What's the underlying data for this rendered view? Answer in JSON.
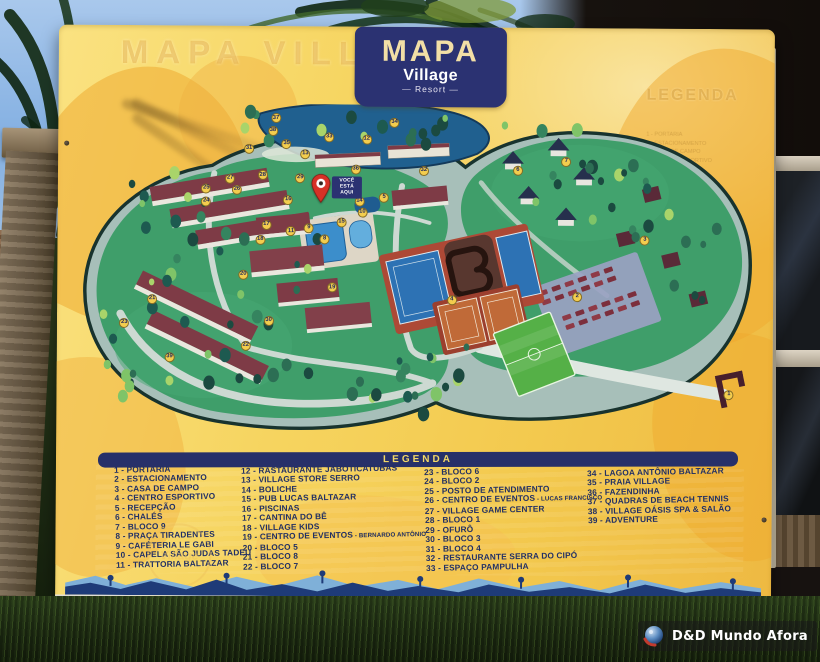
{
  "sign": {
    "title": "MAPA",
    "brand": "Village",
    "brand_sub": "— Resort —",
    "ghost_title": "MAPA VILLAGE",
    "ghost_legend_title": "LEGENDA",
    "you_are_here": "VOCÊ ESTÁ AQUI",
    "legend": {
      "title": "LEGENDA",
      "columns": [
        [
          {
            "n": 1,
            "label": "PORTARIA"
          },
          {
            "n": 2,
            "label": "ESTACIONAMENTO"
          },
          {
            "n": 3,
            "label": "CASA DE CAMPO"
          },
          {
            "n": 4,
            "label": "CENTRO ESPORTIVO"
          },
          {
            "n": 5,
            "label": "RECEPÇÃO"
          },
          {
            "n": 6,
            "label": "CHALÉS"
          },
          {
            "n": 7,
            "label": "BLOCO 9"
          },
          {
            "n": 8,
            "label": "PRAÇA TIRADENTES"
          },
          {
            "n": 9,
            "label": "CAFÉTERIA LE GABI"
          },
          {
            "n": 10,
            "label": "CAPELA SÃO JUDAS TADEU"
          },
          {
            "n": 11,
            "label": "TRATTORIA BALTAZAR"
          }
        ],
        [
          {
            "n": 12,
            "label": "RASTAURANTE JABOTICATUBAS"
          },
          {
            "n": 13,
            "label": "VILLAGE STORE SERRO"
          },
          {
            "n": 14,
            "label": "BOLICHE"
          },
          {
            "n": 15,
            "label": "PUB LUCAS BALTAZAR"
          },
          {
            "n": 16,
            "label": "PISCINAS"
          },
          {
            "n": 17,
            "label": "CANTINA DO BÊ"
          },
          {
            "n": 18,
            "label": "VILLAGE KIDS"
          },
          {
            "n": 19,
            "label": "CENTRO DE EVENTOS",
            "sublabel": "BERNARDO ANTÔNIO"
          },
          {
            "n": 20,
            "label": "BLOCO 5"
          },
          {
            "n": 21,
            "label": "BLOCO 8"
          },
          {
            "n": 22,
            "label": "BLOCO 7"
          }
        ],
        [
          {
            "n": 23,
            "label": "BLOCO 6"
          },
          {
            "n": 24,
            "label": "BLOCO 2"
          },
          {
            "n": 25,
            "label": "POSTO DE ATENDIMENTO"
          },
          {
            "n": 26,
            "label": "CENTRO DE EVENTOS",
            "sublabel": "LUCAS FRANCISCO"
          },
          {
            "n": 27,
            "label": "VILLAGE GAME CENTER"
          },
          {
            "n": 28,
            "label": "BLOCO 1"
          },
          {
            "n": 29,
            "label": "OFURÔ"
          },
          {
            "n": 30,
            "label": "BLOCO 3"
          },
          {
            "n": 31,
            "label": "BLOCO 4"
          },
          {
            "n": 32,
            "label": "RESTAURANTE SERRA DO CIPÓ"
          },
          {
            "n": 33,
            "label": "ESPAÇO PAMPULHA"
          }
        ],
        [
          {
            "n": 34,
            "label": "LAGOA ANTÔNIO BALTAZAR"
          },
          {
            "n": 35,
            "label": "PRAIA VILLAGE"
          },
          {
            "n": 36,
            "label": "FAZENDINHA"
          },
          {
            "n": 37,
            "label": "QUADRAS DE BEACH TENNIS"
          },
          {
            "n": 38,
            "label": "VILLAGE OÁSIS SPA & SALÃO"
          },
          {
            "n": 39,
            "label": "ADVENTURE"
          }
        ]
      ]
    },
    "markers": [
      {
        "n": 1,
        "x": 672,
        "y": 298
      },
      {
        "n": 2,
        "x": 518,
        "y": 198
      },
      {
        "n": 3,
        "x": 586,
        "y": 139
      },
      {
        "n": 4,
        "x": 391,
        "y": 202
      },
      {
        "n": 5,
        "x": 322,
        "y": 96
      },
      {
        "n": 6,
        "x": 457,
        "y": 67
      },
      {
        "n": 7,
        "x": 506,
        "y": 58
      },
      {
        "n": 8,
        "x": 262,
        "y": 140
      },
      {
        "n": 9,
        "x": 246,
        "y": 128
      },
      {
        "n": 10,
        "x": 300,
        "y": 112
      },
      {
        "n": 11,
        "x": 228,
        "y": 132
      },
      {
        "n": 12,
        "x": 304,
        "y": 36
      },
      {
        "n": 13,
        "x": 242,
        "y": 52
      },
      {
        "n": 14,
        "x": 297,
        "y": 100
      },
      {
        "n": 15,
        "x": 279,
        "y": 122
      },
      {
        "n": 16,
        "x": 225,
        "y": 99
      },
      {
        "n": 17,
        "x": 203,
        "y": 125
      },
      {
        "n": 18,
        "x": 197,
        "y": 141
      },
      {
        "n": 19,
        "x": 270,
        "y": 190
      },
      {
        "n": 20,
        "x": 180,
        "y": 177
      },
      {
        "n": 21,
        "x": 88,
        "y": 203
      },
      {
        "n": 22,
        "x": 183,
        "y": 251
      },
      {
        "n": 23,
        "x": 60,
        "y": 228
      },
      {
        "n": 24,
        "x": 142,
        "y": 101
      },
      {
        "n": 25,
        "x": 142,
        "y": 88
      },
      {
        "n": 26,
        "x": 173,
        "y": 89
      },
      {
        "n": 27,
        "x": 166,
        "y": 78
      },
      {
        "n": 28,
        "x": 199,
        "y": 74
      },
      {
        "n": 29,
        "x": 237,
        "y": 77
      },
      {
        "n": 30,
        "x": 206,
        "y": 225
      },
      {
        "n": 31,
        "x": 185,
        "y": 47
      },
      {
        "n": 32,
        "x": 362,
        "y": 68
      },
      {
        "n": 33,
        "x": 266,
        "y": 34
      },
      {
        "n": 34,
        "x": 332,
        "y": 19
      },
      {
        "n": 35,
        "x": 223,
        "y": 41
      },
      {
        "n": 36,
        "x": 293,
        "y": 67
      },
      {
        "n": 37,
        "x": 212,
        "y": 15
      },
      {
        "n": 38,
        "x": 209,
        "y": 28
      },
      {
        "n": 39,
        "x": 106,
        "y": 263
      }
    ]
  },
  "watermark": {
    "text": "D&D Mundo Afora"
  },
  "colors": {
    "navy": "#2b3272",
    "sign_yellow": "#f6d45f",
    "marker_yellow": "#f3cd4e",
    "pin_red": "#d63126",
    "island_green": "#3f9e6a",
    "lake_blue": "#20608f",
    "legend_text": "#223064"
  }
}
